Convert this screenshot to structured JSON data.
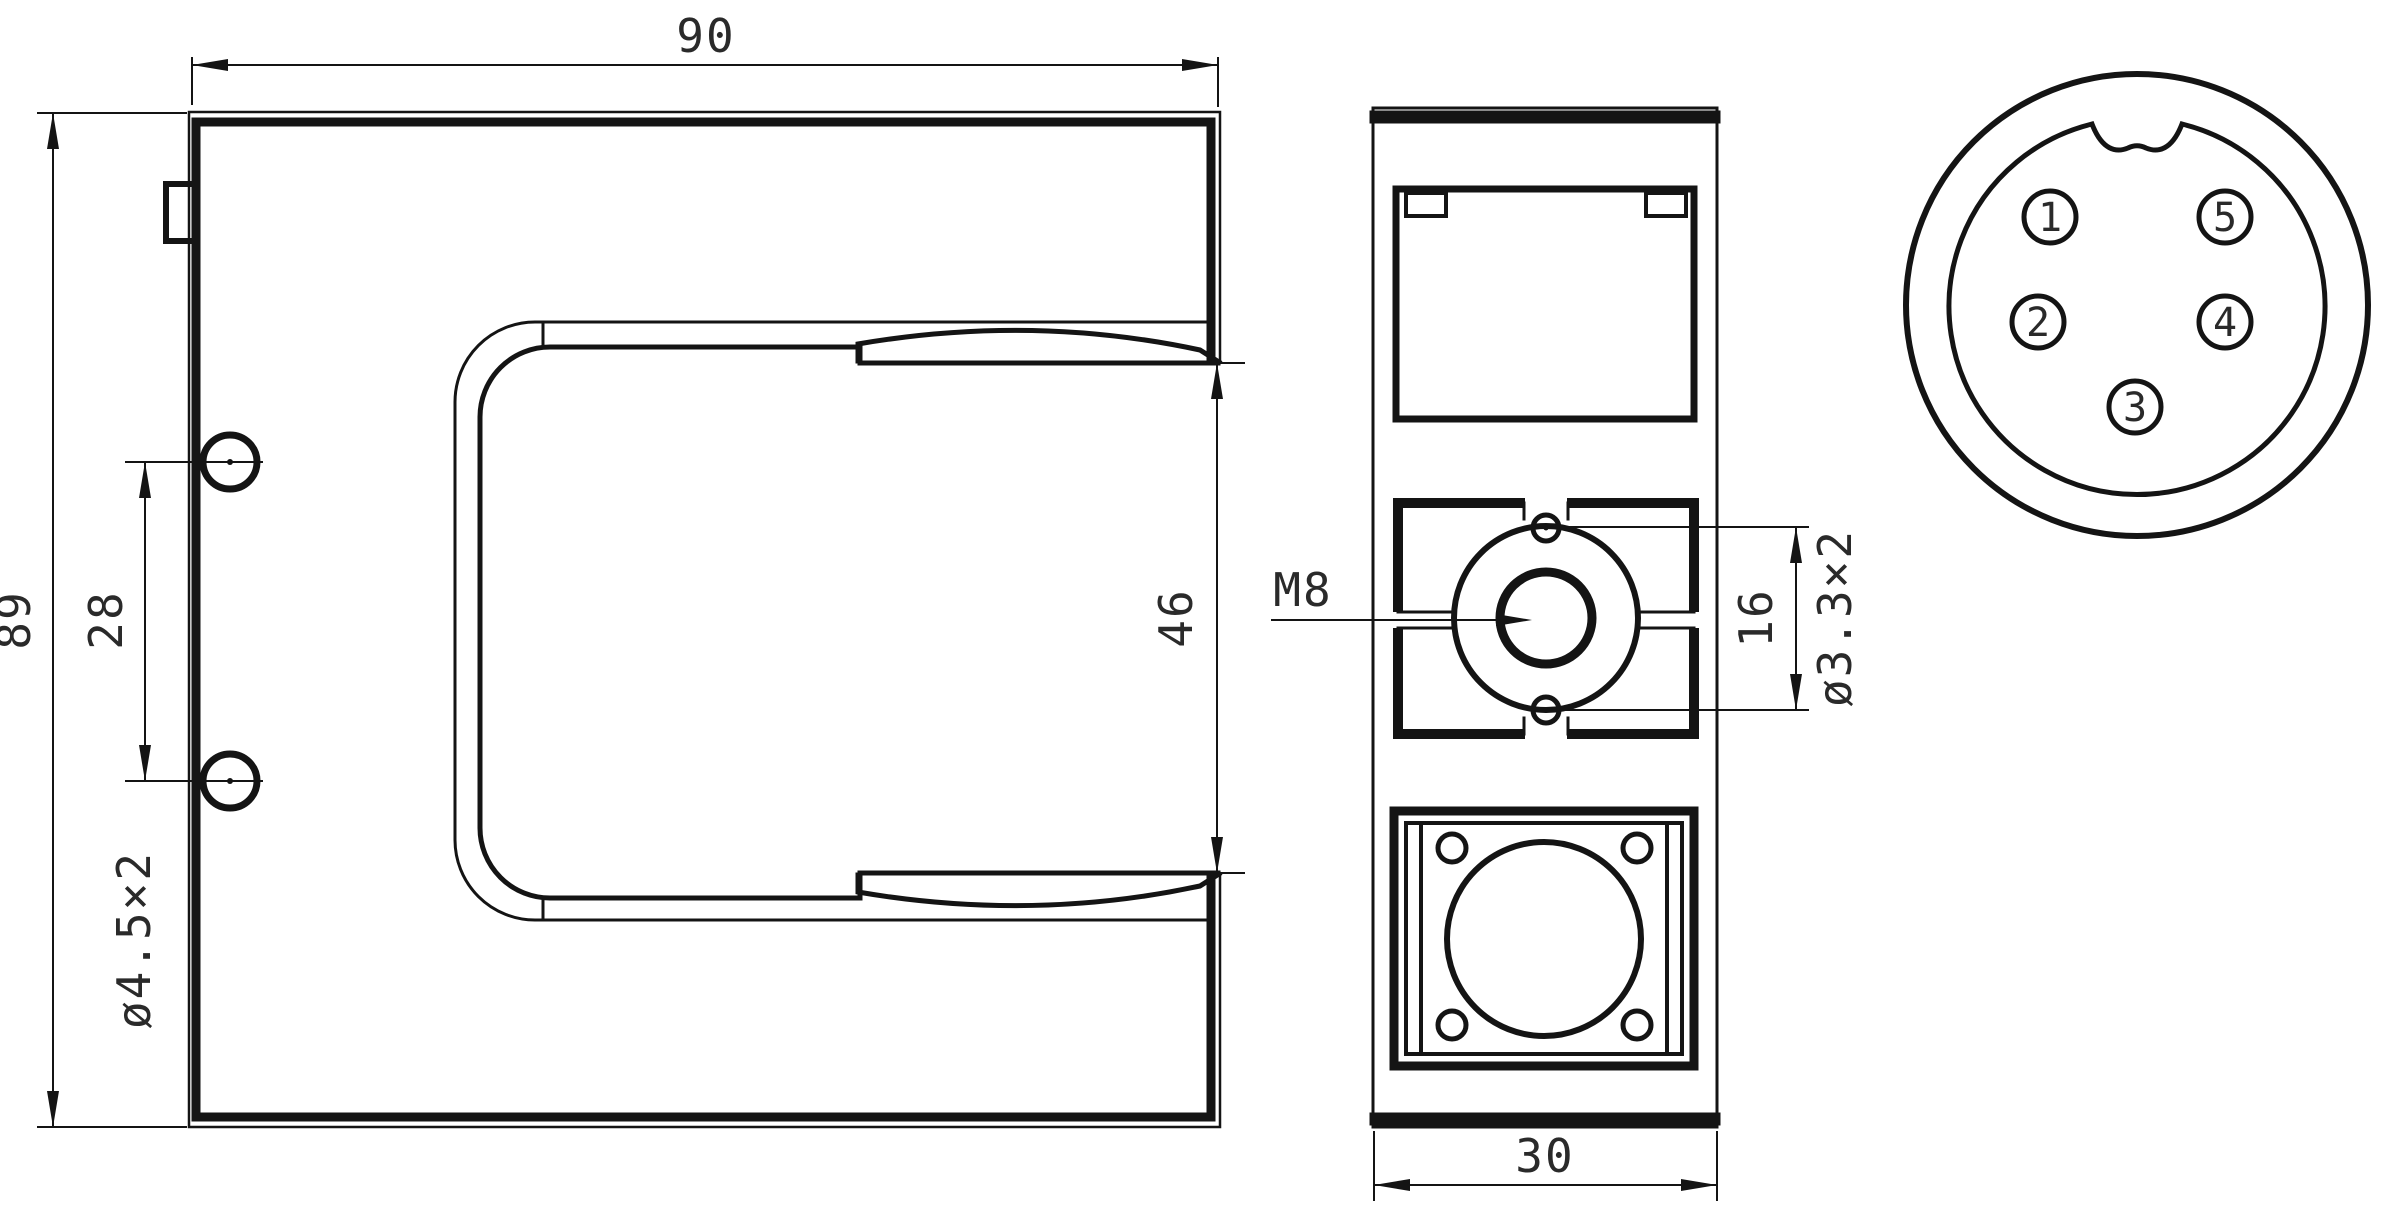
{
  "drawing": {
    "title": "U-slot photoelectric sensor dimensional drawing",
    "background": "#ffffff",
    "line_color": "#141414",
    "front_view": {
      "dims": {
        "width": "90",
        "height": "89",
        "hole_pitch": "28",
        "hole_callout": "ø4.5×2",
        "slot_opening": "46"
      }
    },
    "side_view": {
      "dims": {
        "depth": "30",
        "thread_callout": "M8",
        "hole_pitch": "16",
        "hole_callout": "ø3.3×2"
      }
    },
    "connector_view": {
      "pins": [
        "1",
        "2",
        "3",
        "4",
        "5"
      ]
    }
  }
}
